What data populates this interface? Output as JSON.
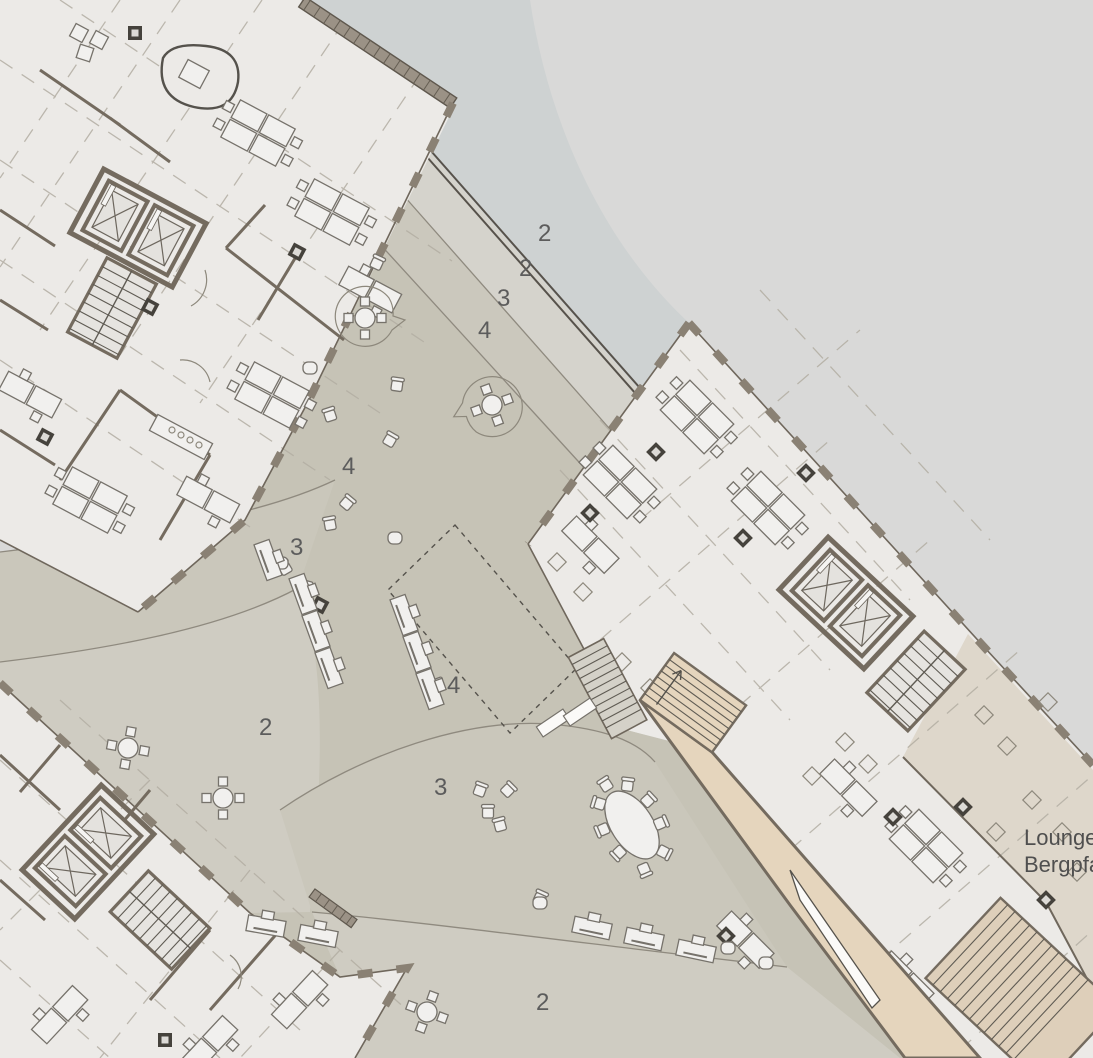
{
  "plan": {
    "title": "architectural ground floor plan",
    "zone_markers": [
      {
        "id": "z0",
        "text": "2"
      },
      {
        "id": "z1",
        "text": "2"
      },
      {
        "id": "z2",
        "text": "3"
      },
      {
        "id": "z3",
        "text": "4"
      },
      {
        "id": "z4",
        "text": "4"
      },
      {
        "id": "z5",
        "text": "3"
      },
      {
        "id": "z6",
        "text": "2"
      },
      {
        "id": "z7",
        "text": "4"
      },
      {
        "id": "z8",
        "text": "3"
      },
      {
        "id": "z9",
        "text": "2"
      }
    ],
    "lounge_label": {
      "line1": "Lounge",
      "line2": "Bergpfad"
    },
    "colors": {
      "background": "#d9d9d8",
      "upper_path_band": "#ced2d2",
      "walkway_band": "#d5d3cc",
      "zone3_band": "#cbc8bd",
      "plaza": "#c6c3b6",
      "zone3_pocket": "#cac7bb",
      "zone2_pocket": "#cfccc2",
      "building_fill": "#eceae7",
      "wall": "#746b5f",
      "ramp": "#e5d5bd",
      "terrace": "#ded7cb",
      "label_text": "#5c5c5c"
    }
  }
}
